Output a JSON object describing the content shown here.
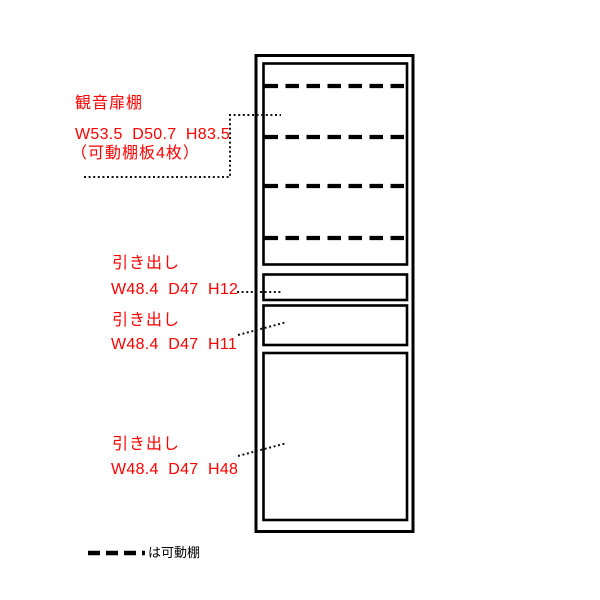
{
  "cabinet": {
    "door_shelf": {
      "title": "観音扉棚",
      "dimensions": "W53.5  D50.7  H83.5",
      "note": "（可動棚板4枚）",
      "movable_shelf_count": 4
    },
    "drawer_top": {
      "title": "引き出し",
      "dimensions": "W48.4  D47  H12"
    },
    "drawer_middle": {
      "title": "引き出し",
      "dimensions": "W48.4  D47  H11"
    },
    "drawer_bottom": {
      "title": "引き出し",
      "dimensions": "W48.4  D47  H48"
    }
  },
  "legend": {
    "dash_label": "は可動棚"
  },
  "colors": {
    "label_text": "#ff0000",
    "line": "#000000",
    "background": "#ffffff"
  }
}
